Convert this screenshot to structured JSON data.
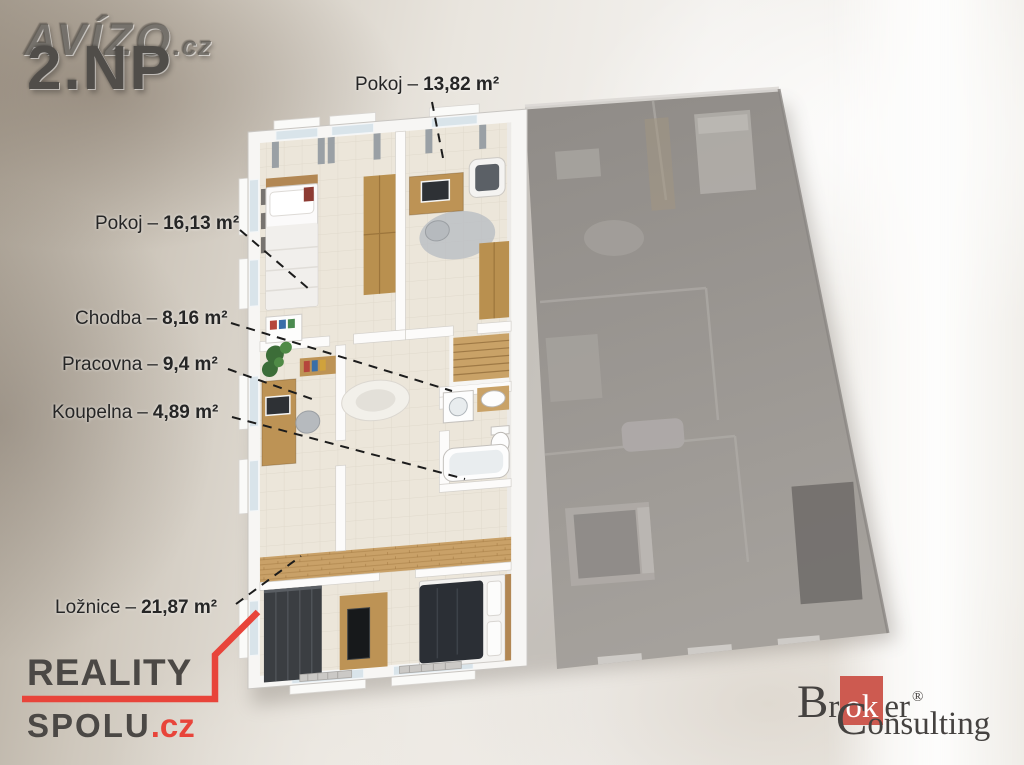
{
  "watermark": {
    "brand": "AVÍZO",
    "brand_tld": ".cz",
    "floor_label": "2.NP"
  },
  "floorplan": {
    "separator": "–",
    "rooms": [
      {
        "name": "Pokoj",
        "area": "13,82 m²"
      },
      {
        "name": "Pokoj",
        "area": "16,13 m²"
      },
      {
        "name": "Chodba",
        "area": "8,16 m²"
      },
      {
        "name": "Pracovna",
        "area": "9,4 m²"
      },
      {
        "name": "Koupelna",
        "area": "4,89 m²"
      },
      {
        "name": "Ložnice",
        "area": "21,87 m²"
      }
    ]
  },
  "logos": {
    "reality_spolu": {
      "line1": "REALITY",
      "line2": "SPOLU",
      "tld": ".cz"
    },
    "broker_consulting": {
      "cap1": "B",
      "rest1": "r",
      "highlight": "ok",
      "after1": "er",
      "registered": "®",
      "cap2": "C",
      "rest2": "onsulting"
    }
  },
  "colors": {
    "accent_red": "#e8443a",
    "broker_red": "#cd5a50",
    "label_color": "#262626",
    "reality_text": "#4b4845",
    "broker_text": "#454240",
    "floor_label_color": "#504d49"
  }
}
